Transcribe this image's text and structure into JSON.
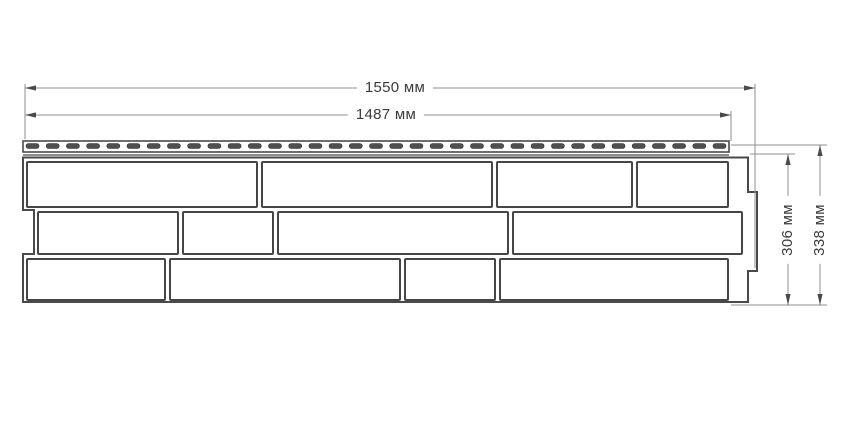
{
  "dimensions": {
    "width_total": "1550 мм",
    "width_nail": "1487 мм",
    "height_body": "306 мм",
    "height_total": "338 мм"
  },
  "colors": {
    "outline": "#4a4a4a",
    "brick_stroke": "#464646",
    "dim_line": "#8f8f8f",
    "arrow": "#4a4a4a",
    "slot_fill": "#4f4f4f",
    "slot_stroke": "#333333",
    "text": "#3b3b3b",
    "background": "#ffffff"
  },
  "diagram": {
    "type": "technical-drawing",
    "panel_body_path": "M23,157.5 L748,157.5 L748,192 L757,192 L757,271 L748,271 L748,302 L23,302 L23,254 L34,254 L34,210 L23,210 Z",
    "nail_strip": {
      "x": 23,
      "y": 141,
      "w": 706,
      "h": 11
    },
    "strip_inner_line": {
      "x1": 23,
      "y1": 155,
      "x2": 729,
      "y2": 155
    },
    "slots": {
      "count": 35,
      "x_start": 26,
      "x_end": 726,
      "y": 143.5,
      "w": 13,
      "h": 5,
      "r": 2.5
    },
    "brick_rows": [
      {
        "y": 162,
        "h": 45,
        "bricks": [
          [
            27,
            230
          ],
          [
            262,
            230
          ],
          [
            497,
            135
          ],
          [
            637,
            91
          ]
        ]
      },
      {
        "y": 212,
        "h": 42,
        "bricks": [
          [
            38,
            140
          ],
          [
            183,
            90
          ],
          [
            278,
            230
          ],
          [
            513,
            229
          ]
        ]
      },
      {
        "y": 259,
        "h": 41,
        "bricks": [
          [
            27,
            138
          ],
          [
            170,
            230
          ],
          [
            405,
            90
          ],
          [
            500,
            228
          ]
        ]
      }
    ],
    "label_anchors": {
      "width_total": {
        "x": 395,
        "y": 88
      },
      "width_nail": {
        "x": 386,
        "y": 115
      },
      "height_body": {
        "x": 788,
        "y": 230
      },
      "height_total": {
        "x": 820,
        "y": 230
      }
    }
  }
}
